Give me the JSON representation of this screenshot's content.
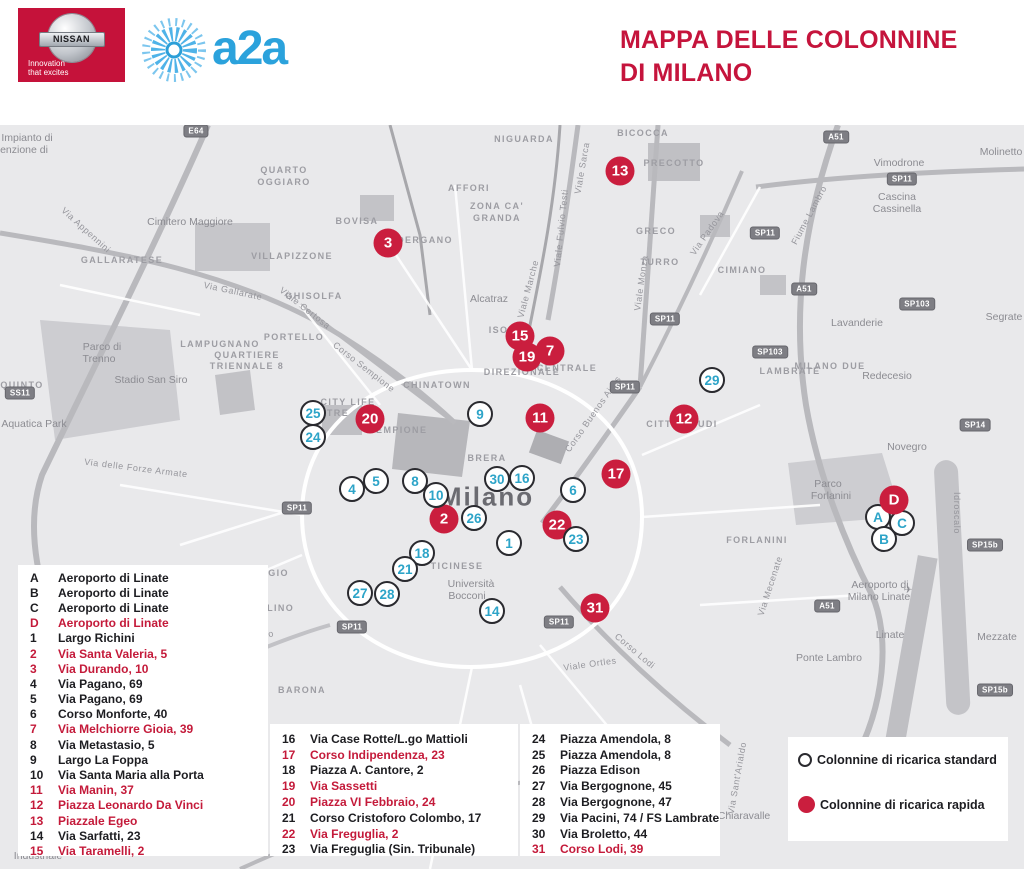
{
  "header": {
    "nissan": {
      "name": "NISSAN",
      "tagline_line1": "Innovation",
      "tagline_line2": "that excites"
    },
    "a2a": {
      "name": "a2a"
    },
    "title_line1": "MAPPA DELLE COLONNINE",
    "title_line2": "DI MILANO"
  },
  "colors": {
    "accent_red": "#c5143c",
    "marker_rapid_red": "#ca1e3e",
    "marker_number_teal": "#2da4c8",
    "a2a_blue": "#2ba2dc",
    "map_background": "#e9e9eb"
  },
  "legend_key": {
    "standard_label": "Colonnine di ricarica standard",
    "rapid_label": "Colonnine di ricarica rapida"
  },
  "legend_columns": [
    [
      "A",
      "B",
      "C",
      "D",
      "1",
      "2",
      "3",
      "4",
      "5",
      "6",
      "7",
      "8",
      "9",
      "10",
      "11",
      "12",
      "13",
      "14",
      "15"
    ],
    [
      "16",
      "17",
      "18",
      "19",
      "20",
      "21",
      "22",
      "23"
    ],
    [
      "24",
      "25",
      "26",
      "27",
      "28",
      "29",
      "30",
      "31"
    ]
  ],
  "locations": [
    {
      "key": "A",
      "label": "Aeroporto di Linate",
      "type": "standard",
      "x": 878,
      "y": 517
    },
    {
      "key": "B",
      "label": "Aeroporto di Linate",
      "type": "standard",
      "x": 884,
      "y": 539
    },
    {
      "key": "C",
      "label": "Aeroporto di Linate",
      "type": "standard",
      "x": 902,
      "y": 523
    },
    {
      "key": "D",
      "label": "Aeroporto di Linate",
      "type": "rapid",
      "x": 894,
      "y": 500
    },
    {
      "key": "1",
      "label": "Largo Richini",
      "type": "standard",
      "x": 509,
      "y": 543
    },
    {
      "key": "2",
      "label": "Via Santa Valeria, 5",
      "type": "rapid",
      "x": 444,
      "y": 519
    },
    {
      "key": "3",
      "label": "Via Durando, 10",
      "type": "rapid",
      "x": 388,
      "y": 243
    },
    {
      "key": "4",
      "label": "Via Pagano, 69",
      "type": "standard",
      "x": 352,
      "y": 489
    },
    {
      "key": "5",
      "label": "Via Pagano, 69",
      "type": "standard",
      "x": 376,
      "y": 481
    },
    {
      "key": "6",
      "label": "Corso Monforte, 40",
      "type": "standard",
      "x": 573,
      "y": 490
    },
    {
      "key": "7",
      "label": "Via Melchiorre Gioia, 39",
      "type": "rapid",
      "x": 550,
      "y": 351
    },
    {
      "key": "8",
      "label": "Via Metastasio, 5",
      "type": "standard",
      "x": 415,
      "y": 481
    },
    {
      "key": "9",
      "label": "Largo La Foppa",
      "type": "standard",
      "x": 480,
      "y": 414
    },
    {
      "key": "10",
      "label": "Via Santa Maria alla Porta",
      "type": "standard",
      "x": 436,
      "y": 495
    },
    {
      "key": "11",
      "label": "Via Manin, 37",
      "type": "rapid",
      "x": 540,
      "y": 418
    },
    {
      "key": "12",
      "label": "Piazza Leonardo Da Vinci",
      "type": "rapid",
      "x": 684,
      "y": 419
    },
    {
      "key": "13",
      "label": "Piazzale Egeo",
      "type": "rapid",
      "x": 620,
      "y": 171
    },
    {
      "key": "14",
      "label": "Via Sarfatti, 23",
      "type": "standard",
      "x": 492,
      "y": 611
    },
    {
      "key": "15",
      "label": "Via Taramelli, 2",
      "type": "rapid",
      "x": 520,
      "y": 336
    },
    {
      "key": "16",
      "label": "Via Case Rotte/L.go Mattioli",
      "type": "standard",
      "x": 522,
      "y": 478
    },
    {
      "key": "17",
      "label": "Corso Indipendenza, 23",
      "type": "rapid",
      "x": 616,
      "y": 474
    },
    {
      "key": "18",
      "label": "Piazza A. Cantore, 2",
      "type": "standard",
      "x": 422,
      "y": 553
    },
    {
      "key": "19",
      "label": "Via Sassetti",
      "type": "rapid",
      "x": 527,
      "y": 357
    },
    {
      "key": "20",
      "label": "Piazza VI Febbraio, 24",
      "type": "rapid",
      "x": 370,
      "y": 419
    },
    {
      "key": "21",
      "label": "Corso Cristoforo Colombo, 17",
      "type": "standard",
      "x": 405,
      "y": 569
    },
    {
      "key": "22",
      "label": "Via Freguglia, 2",
      "type": "rapid",
      "x": 557,
      "y": 525
    },
    {
      "key": "23",
      "label": "Via Freguglia (Sin. Tribunale)",
      "type": "standard",
      "x": 576,
      "y": 539
    },
    {
      "key": "24",
      "label": "Piazza Amendola, 8",
      "type": "standard",
      "x": 313,
      "y": 437
    },
    {
      "key": "25",
      "label": "Piazza Amendola, 8",
      "type": "standard",
      "x": 313,
      "y": 413
    },
    {
      "key": "26",
      "label": "Piazza Edison",
      "type": "standard",
      "x": 474,
      "y": 518
    },
    {
      "key": "27",
      "label": "Via Bergognone, 45",
      "type": "standard",
      "x": 360,
      "y": 593
    },
    {
      "key": "28",
      "label": "Via Bergognone, 47",
      "type": "standard",
      "x": 387,
      "y": 594
    },
    {
      "key": "29",
      "label": "Via Pacini, 74 / FS Lambrate",
      "type": "standard",
      "x": 712,
      "y": 380
    },
    {
      "key": "30",
      "label": "Via Broletto, 44",
      "type": "standard",
      "x": 497,
      "y": 479
    },
    {
      "key": "31",
      "label": "Corso Lodi, 39",
      "type": "rapid",
      "x": 595,
      "y": 608
    }
  ],
  "map_labels": [
    {
      "t": "QUARTO",
      "x": 284,
      "y": 170,
      "k": "d"
    },
    {
      "t": "OGGIARO",
      "x": 284,
      "y": 182,
      "k": "d"
    },
    {
      "t": "VILLAPIZZONE",
      "x": 292,
      "y": 256,
      "k": "d"
    },
    {
      "t": "GALLARATESE",
      "x": 122,
      "y": 260,
      "k": "d"
    },
    {
      "t": "LAMPUGNANO",
      "x": 220,
      "y": 344,
      "k": "d"
    },
    {
      "t": "QUARTIERE",
      "x": 247,
      "y": 355,
      "k": "d"
    },
    {
      "t": "TRIENNALE 8",
      "x": 247,
      "y": 366,
      "k": "d"
    },
    {
      "t": "PORTELLO",
      "x": 294,
      "y": 337,
      "k": "d"
    },
    {
      "t": "GHISOLFA",
      "x": 314,
      "y": 296,
      "k": "d"
    },
    {
      "t": "BOVISA",
      "x": 357,
      "y": 221,
      "k": "d"
    },
    {
      "t": "DERGANO",
      "x": 425,
      "y": 240,
      "k": "d"
    },
    {
      "t": "AFFORI",
      "x": 469,
      "y": 188,
      "k": "d"
    },
    {
      "t": "NIGUARDA",
      "x": 524,
      "y": 139,
      "k": "d"
    },
    {
      "t": "ZONA CA'",
      "x": 497,
      "y": 206,
      "k": "d"
    },
    {
      "t": "GRANDA",
      "x": 497,
      "y": 218,
      "k": "d"
    },
    {
      "t": "BICOCCA",
      "x": 643,
      "y": 133,
      "k": "d"
    },
    {
      "t": "PRECOTTO",
      "x": 674,
      "y": 163,
      "k": "d"
    },
    {
      "t": "GRECO",
      "x": 656,
      "y": 231,
      "k": "d"
    },
    {
      "t": "TURRO",
      "x": 660,
      "y": 262,
      "k": "d"
    },
    {
      "t": "CIMIANO",
      "x": 742,
      "y": 270,
      "k": "d"
    },
    {
      "t": "MILANO DUE",
      "x": 830,
      "y": 366,
      "k": "d"
    },
    {
      "t": "LAMBRATE",
      "x": 790,
      "y": 371,
      "k": "d"
    },
    {
      "t": "CITTÀ STUDI",
      "x": 682,
      "y": 424,
      "k": "d"
    },
    {
      "t": "FORLANINI",
      "x": 757,
      "y": 540,
      "k": "d"
    },
    {
      "t": "ISOLA",
      "x": 506,
      "y": 330,
      "k": "d"
    },
    {
      "t": "CENTRALE",
      "x": 567,
      "y": 368,
      "k": "d"
    },
    {
      "t": "DIREZIONALE",
      "x": 522,
      "y": 372,
      "k": "d"
    },
    {
      "t": "CHINATOWN",
      "x": 437,
      "y": 385,
      "k": "d"
    },
    {
      "t": "BRERA",
      "x": 487,
      "y": 458,
      "k": "d"
    },
    {
      "t": "CITY LIFE",
      "x": 348,
      "y": 402,
      "k": "d"
    },
    {
      "t": "TRE",
      "x": 338,
      "y": 413,
      "k": "d"
    },
    {
      "t": "SEMPIONE",
      "x": 398,
      "y": 430,
      "k": "d"
    },
    {
      "t": "TICINESE",
      "x": 457,
      "y": 566,
      "k": "d"
    },
    {
      "t": "LORENTEGGIO",
      "x": 248,
      "y": 573,
      "k": "d"
    },
    {
      "t": "GIAMBELLINO",
      "x": 255,
      "y": 608,
      "k": "d"
    },
    {
      "t": "BARONA",
      "x": 302,
      "y": 690,
      "k": "d"
    },
    {
      "t": "QUINTO",
      "x": 22,
      "y": 385,
      "k": "d"
    },
    {
      "t": "Impianto di",
      "x": 27,
      "y": 138,
      "k": "p"
    },
    {
      "t": "enzione di",
      "x": 24,
      "y": 150,
      "k": "p"
    },
    {
      "t": "Cimitero Maggiore",
      "x": 190,
      "y": 222,
      "k": "p"
    },
    {
      "t": "Parco di",
      "x": 102,
      "y": 347,
      "k": "p"
    },
    {
      "t": "Trenno",
      "x": 99,
      "y": 359,
      "k": "p"
    },
    {
      "t": "Stadio San Siro",
      "x": 151,
      "y": 380,
      "k": "p"
    },
    {
      "t": "Aquatica Park",
      "x": 34,
      "y": 424,
      "k": "p"
    },
    {
      "t": "Alcatraz",
      "x": 489,
      "y": 299,
      "k": "p"
    },
    {
      "t": "Vimodrone",
      "x": 899,
      "y": 163,
      "k": "p"
    },
    {
      "t": "Molinetto",
      "x": 1001,
      "y": 152,
      "k": "p"
    },
    {
      "t": "Cascina",
      "x": 897,
      "y": 197,
      "k": "p"
    },
    {
      "t": "Cassinella",
      "x": 897,
      "y": 209,
      "k": "p"
    },
    {
      "t": "Lavanderie",
      "x": 857,
      "y": 323,
      "k": "p"
    },
    {
      "t": "Segrate",
      "x": 1004,
      "y": 317,
      "k": "p"
    },
    {
      "t": "Redecesio",
      "x": 887,
      "y": 376,
      "k": "p"
    },
    {
      "t": "Novegro",
      "x": 907,
      "y": 447,
      "k": "p"
    },
    {
      "t": "Parco",
      "x": 828,
      "y": 484,
      "k": "p"
    },
    {
      "t": "Forlanini",
      "x": 831,
      "y": 496,
      "k": "p"
    },
    {
      "t": "Aeroporto di",
      "x": 880,
      "y": 585,
      "k": "p"
    },
    {
      "t": "Milano Linate",
      "x": 879,
      "y": 597,
      "k": "p"
    },
    {
      "t": "✈",
      "x": 908,
      "y": 590,
      "k": "p"
    },
    {
      "t": "Linate",
      "x": 890,
      "y": 635,
      "k": "p"
    },
    {
      "t": "Mezzate",
      "x": 997,
      "y": 637,
      "k": "p"
    },
    {
      "t": "Ponte Lambro",
      "x": 829,
      "y": 658,
      "k": "p"
    },
    {
      "t": "Chiaravalle",
      "x": 744,
      "y": 816,
      "k": "p"
    },
    {
      "t": "Università",
      "x": 471,
      "y": 584,
      "k": "p"
    },
    {
      "t": "Bocconi",
      "x": 467,
      "y": 596,
      "k": "p"
    },
    {
      "t": "Industriale",
      "x": 38,
      "y": 856,
      "k": "p"
    },
    {
      "t": "Milano",
      "x": 487,
      "y": 497,
      "k": "c"
    },
    {
      "t": "Via Gallarate",
      "x": 233,
      "y": 291,
      "k": "r",
      "r": 12
    },
    {
      "t": "Viale Certosa",
      "x": 305,
      "y": 308,
      "k": "r",
      "r": 38
    },
    {
      "t": "Via Appennini",
      "x": 86,
      "y": 230,
      "k": "r",
      "r": 42
    },
    {
      "t": "Corso Sempione",
      "x": 364,
      "y": 367,
      "k": "r",
      "r": 38
    },
    {
      "t": "Viale Marche",
      "x": 528,
      "y": 289,
      "k": "r",
      "r": -75
    },
    {
      "t": "Viale Fulvio Testi",
      "x": 561,
      "y": 228,
      "k": "r",
      "r": -84
    },
    {
      "t": "Viale Sarca",
      "x": 582,
      "y": 168,
      "k": "r",
      "r": -80
    },
    {
      "t": "Viale Monza",
      "x": 641,
      "y": 283,
      "k": "r",
      "r": -82
    },
    {
      "t": "Via Padova",
      "x": 707,
      "y": 233,
      "k": "r",
      "r": -55
    },
    {
      "t": "Corso Buenos Aires",
      "x": 593,
      "y": 414,
      "k": "r",
      "r": -55
    },
    {
      "t": "Corso Lodi",
      "x": 635,
      "y": 651,
      "k": "r",
      "r": 40
    },
    {
      "t": "Viale Ortles",
      "x": 590,
      "y": 664,
      "k": "r",
      "r": -8
    },
    {
      "t": "Via delle Forze Armate",
      "x": 136,
      "y": 468,
      "k": "r",
      "r": 7
    },
    {
      "t": "Via Mecenate",
      "x": 770,
      "y": 586,
      "k": "r",
      "r": -72
    },
    {
      "t": "Idroscalo",
      "x": 957,
      "y": 513,
      "k": "r",
      "r": 90
    },
    {
      "t": "Fiume Lambro",
      "x": 809,
      "y": 215,
      "k": "r",
      "r": -62
    },
    {
      "t": "Lodovico il Moro",
      "x": 237,
      "y": 641,
      "k": "r",
      "r": -12
    },
    {
      "t": "Via Sant'Arialdo",
      "x": 737,
      "y": 778,
      "k": "r",
      "r": -80
    }
  ],
  "road_badges": [
    {
      "t": "E64",
      "x": 196,
      "y": 131
    },
    {
      "t": "SS11",
      "x": 20,
      "y": 393
    },
    {
      "t": "SP11",
      "x": 297,
      "y": 508
    },
    {
      "t": "SP11",
      "x": 352,
      "y": 627
    },
    {
      "t": "SP11",
      "x": 559,
      "y": 622
    },
    {
      "t": "SP11",
      "x": 665,
      "y": 319
    },
    {
      "t": "SP11",
      "x": 625,
      "y": 387
    },
    {
      "t": "SP11",
      "x": 902,
      "y": 179
    },
    {
      "t": "SP11",
      "x": 765,
      "y": 233
    },
    {
      "t": "A51",
      "x": 836,
      "y": 137
    },
    {
      "t": "A51",
      "x": 804,
      "y": 289
    },
    {
      "t": "A51",
      "x": 827,
      "y": 606
    },
    {
      "t": "SP103",
      "x": 917,
      "y": 304
    },
    {
      "t": "SP103",
      "x": 770,
      "y": 352
    },
    {
      "t": "SP14",
      "x": 975,
      "y": 425
    },
    {
      "t": "SP15b",
      "x": 985,
      "y": 545
    },
    {
      "t": "SP15b",
      "x": 995,
      "y": 690
    }
  ]
}
